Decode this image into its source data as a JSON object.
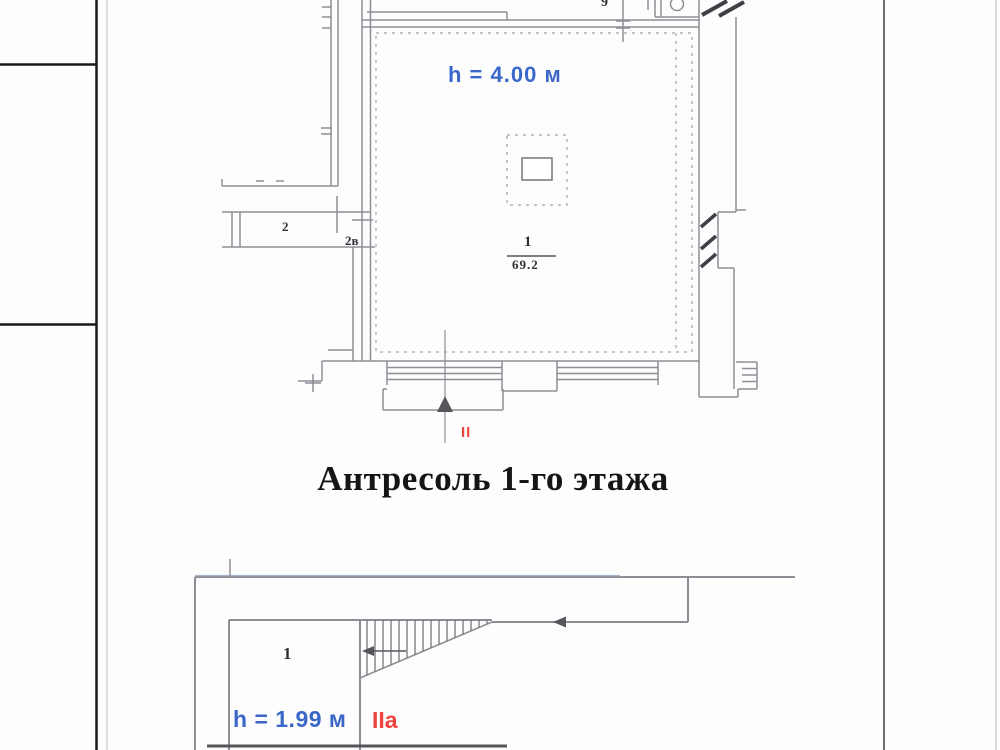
{
  "document": {
    "title": "Антресоль 1-го этажа"
  },
  "upper_plan": {
    "height_label": "h = 4.00 м",
    "room_number": "1",
    "room_area": "69.2",
    "adjacent_room_number": "2",
    "adjacent_room_label": "2в",
    "corner_mark": "9",
    "axis_mark": "II"
  },
  "lower_plan": {
    "room_number": "1",
    "height_label": "h = 1.99 м",
    "axis_mark": "IIа"
  },
  "colors": {
    "height_label_blue": "#3a67c8",
    "axis_mark_red": "#ee443e",
    "wall_line_gray": "#8e8e96",
    "dark_line": "#55555c",
    "table_edge_black": "#1a1a1a"
  }
}
